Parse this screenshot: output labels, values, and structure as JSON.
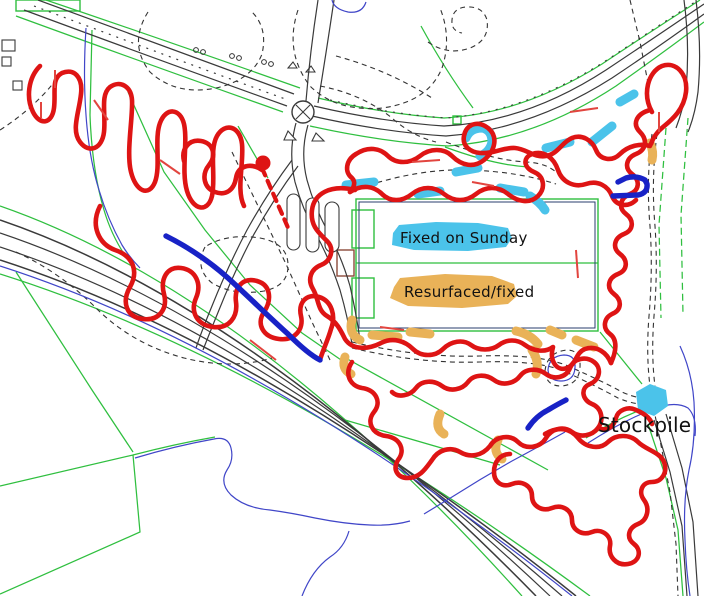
{
  "map": {
    "labels": {
      "fixed_on_sunday": {
        "text": "Fixed on Sunday",
        "highlight": "#4BC3EA"
      },
      "resurfaced_fixed": {
        "text": "Resurfaced/fixed",
        "highlight": "#E9B258"
      },
      "stockpile": {
        "text": "Stockpile"
      }
    },
    "legend": [
      {
        "label": "Fixed on Sunday",
        "color": "#4BC3EA",
        "meaning": "cyan highlighted trail segments"
      },
      {
        "label": "Resurfaced/fixed",
        "color": "#E9B258",
        "meaning": "orange highlighted trail segments"
      }
    ],
    "colors": {
      "trail_red": "#DE1414",
      "trail_blue": "#1822C6",
      "highlight_cyan": "#4BC3EA",
      "highlight_orange": "#E9B258",
      "field_green": "#2FBF3F",
      "road_dark": "#3A3A3A",
      "path_dash": "#333333",
      "stream_blue": "#4046C8",
      "arrow_red": "#E2453F",
      "start_dot_red": "#DE1414",
      "building_brown": "#8B4A3A",
      "pitch_navy": "#2A3C6E",
      "label_text": "#111111"
    }
  }
}
